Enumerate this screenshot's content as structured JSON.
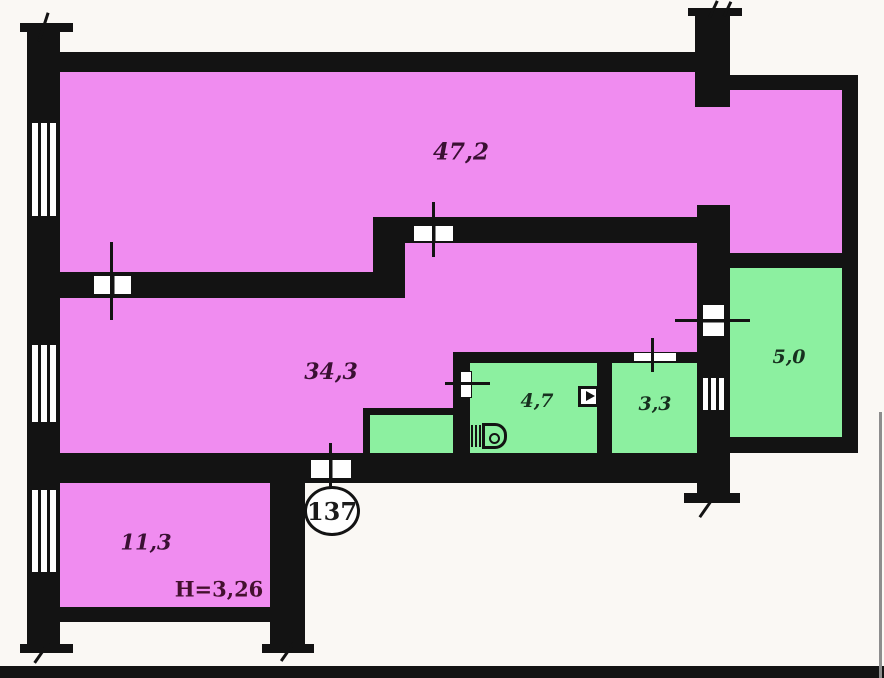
{
  "title": "apartment-floor-plan",
  "colors": {
    "background": "#faf8f4",
    "wall": "#131313",
    "room_pink": "#f08cf0",
    "room_green": "#8cf0a0",
    "label_pink_room": "#3a1033",
    "label_green_room": "#17301f",
    "label_height": "#43102e",
    "label_number": "#1b1b1b",
    "edge_shadow": "#8d8d8d"
  },
  "rooms": [
    {
      "area": "47,2",
      "fill": "pink"
    },
    {
      "area": "34,3",
      "fill": "pink"
    },
    {
      "area": "11,3",
      "fill": "pink"
    },
    {
      "area": "4,7",
      "fill": "green"
    },
    {
      "area": "3,3",
      "fill": "green"
    },
    {
      "area": "5,0",
      "fill": "green"
    }
  ],
  "annotations": {
    "ceiling_height": "H=3,26",
    "apartment_number": "137"
  },
  "icons": {
    "toilet": "toilet-icon",
    "switch": "wall-switch-icon",
    "window": "window-icon",
    "door": "door-opening-icon"
  }
}
